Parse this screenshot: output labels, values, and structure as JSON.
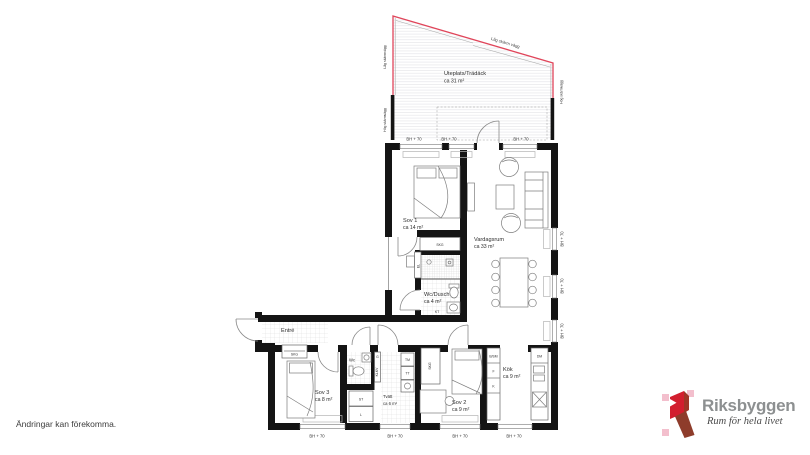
{
  "window_head_label": "BH + 70",
  "terrace": {
    "name": "Uteplats/Trädäck",
    "area": "ca 31 m²",
    "screen_low_top": "Låg skärm vägg",
    "screen_low_left": "Låg skärmvägg",
    "screen_high_left": "Hög skärmvägg",
    "screen_high_right": "Hög skärmvägg"
  },
  "rooms": {
    "sov1": {
      "name": "Sov 1",
      "area": "ca 14 m²"
    },
    "vardagsrum": {
      "name": "Vardagsrum",
      "area": "ca 33 m²"
    },
    "wc_dusch": {
      "name": "Wc/Dusch",
      "area": "ca 4 m²"
    },
    "entre": {
      "name": "Entré"
    },
    "sov3": {
      "name": "Sov 3",
      "area": "ca 8 m²"
    },
    "wc": {
      "name": "Wc"
    },
    "tvatt": {
      "name": "Tvätt",
      "area": "ca 6 m²"
    },
    "sov2": {
      "name": "Sov 2",
      "area": "ca 9 m²"
    },
    "kok": {
      "name": "Kök",
      "area": "ca 9 m²"
    }
  },
  "fixtures": {
    "skg": "SKG",
    "el": "EL",
    "tm": "TM",
    "tt": "TT",
    "st": "ST",
    "l": "L",
    "g": "G",
    "klkv": "KLKV",
    "b_sm": "B/SM",
    "f": "F",
    "k": "K",
    "dm": "DM",
    "kt": "KT"
  },
  "footer": {
    "disclaimer": "Ändringar kan förekomma."
  },
  "brand": {
    "name": "Riksbyggen",
    "tagline": "Rum för hela livet"
  }
}
